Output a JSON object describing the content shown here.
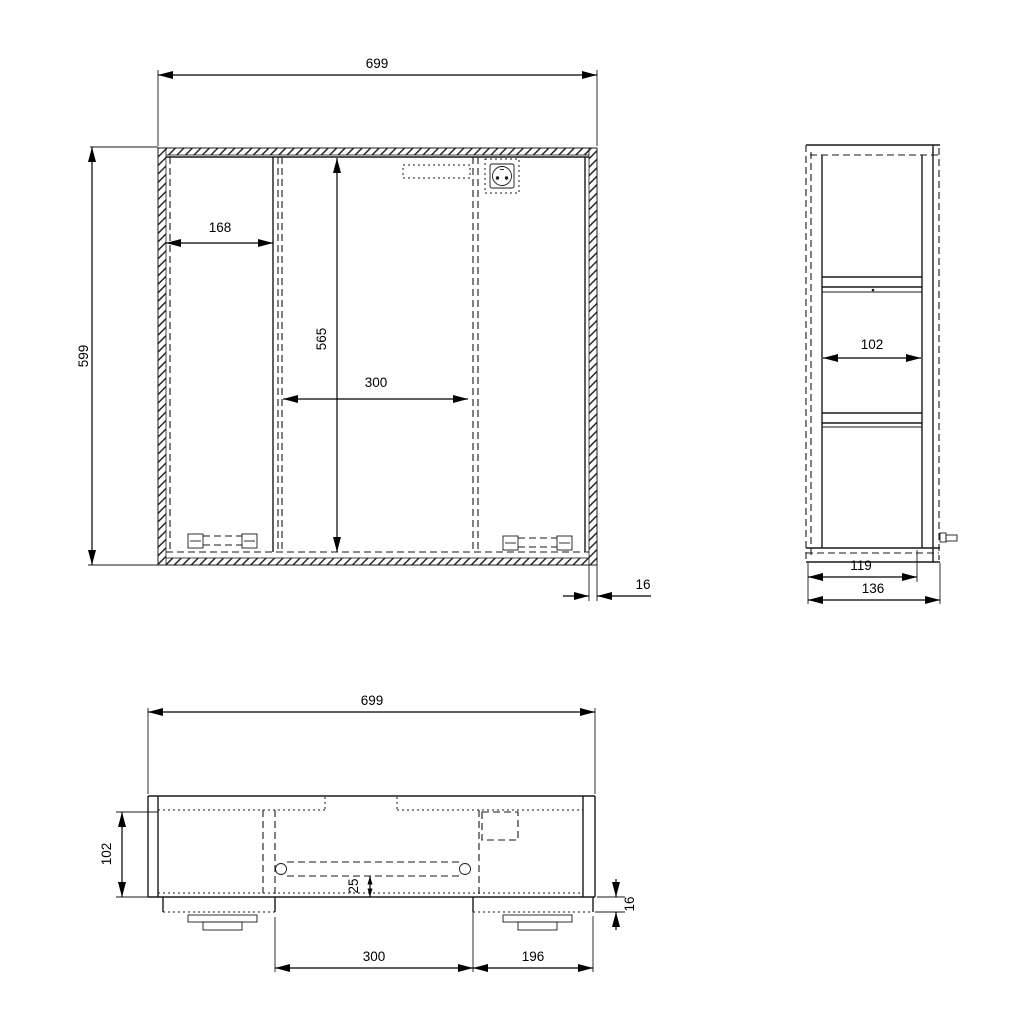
{
  "drawing": {
    "background": "#ffffff",
    "line_color": "#1a1a1a",
    "views": {
      "front": {
        "label": "front view",
        "dims": {
          "overall_width": "699",
          "overall_height": "599",
          "left_door_width": "168",
          "opening_height": "565",
          "opening_width": "300",
          "panel_thickness": "16"
        }
      },
      "side": {
        "label": "side view",
        "dims": {
          "inner_depth": "102",
          "carcass_depth": "119",
          "overall_depth": "136"
        }
      },
      "bottom": {
        "label": "bottom view",
        "dims": {
          "overall_width": "699",
          "body_depth": "102",
          "rail_inset": "25",
          "door_thickness": "16",
          "opening_width": "300",
          "right_door_width": "196"
        }
      }
    },
    "icons": {
      "socket": "power-socket"
    }
  }
}
